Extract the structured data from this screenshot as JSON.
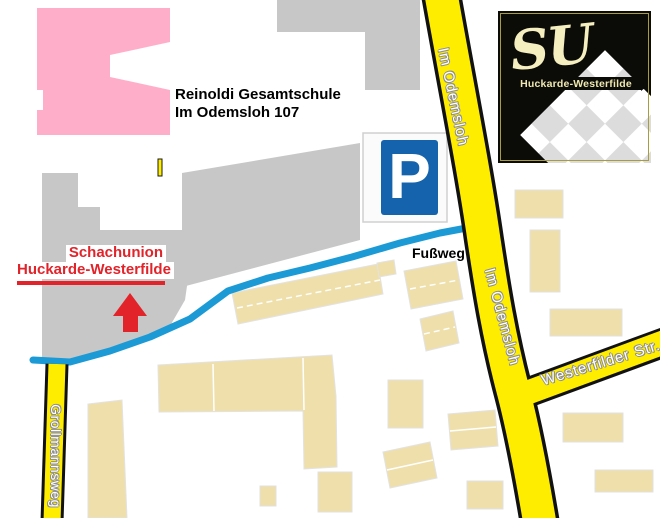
{
  "map": {
    "school_label": {
      "line1": "Reinoldi Gesamtschule",
      "line2": "Im Odemsloh 107"
    },
    "club_label": {
      "line1": "Schachunion",
      "line2": "Huckarde-Westerfilde"
    },
    "footpath_label": "Fußweg",
    "parking_symbol": "P",
    "roads": {
      "im_odemsloh_upper": "Im Odemsloh",
      "im_odemsloh_lower": "Im Odemsloh",
      "westerfilder_str": "Westerfilder Str.",
      "grollmannsweg": "Grollmannsweg"
    },
    "logo": {
      "initials": "SU",
      "club_name": "Huckarde-Westerfilde"
    },
    "colors": {
      "road_yellow": "#ffed00",
      "footpath_blue": "#1b9ad6",
      "building_gray": "#c7c7c7",
      "building_beige": "#efdfab",
      "school_pink": "#ffaec9",
      "accent_red": "#e2232a",
      "parking_blue": "#1563ac",
      "logo_cream": "#efe8b0"
    }
  }
}
